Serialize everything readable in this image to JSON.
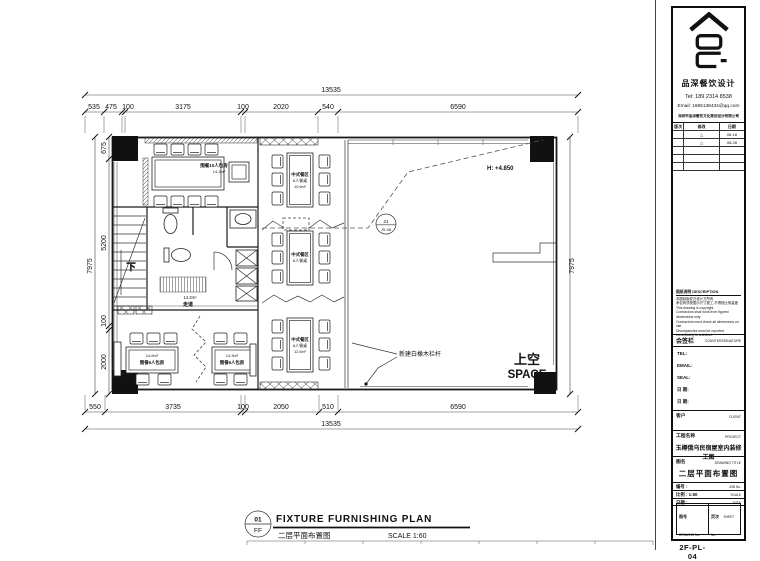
{
  "titleblock": {
    "firm": {
      "name": "品深餐饮设计",
      "tel": "Tel: 189 2314 8538",
      "email": "Email: 1665138434@qq.com",
      "company": "深圳市品深餐饮文化策划设计有限公司"
    },
    "revisions": {
      "col_mark": "版次",
      "col_note": "修改",
      "col_date": "日期",
      "rows": [
        {
          "mark": "△",
          "date": "08.18"
        },
        {
          "mark": "△",
          "date": "08.28"
        }
      ]
    },
    "notes": {
      "title": "图纸说明 DESCRIPTION",
      "lines": [
        "本图纸版权归设计方所有",
        "承包商须按图示尺寸施工,不得按比例量度",
        "This drawing is copyright.",
        "Contractors shall work from figured dimensions only.",
        "Contractors must check all dimensions on site.",
        "Discrepancies must be reported immediately to architect."
      ]
    },
    "countersign": {
      "cn": "会签栏",
      "en": "COUNTERSIGNATURE"
    },
    "sign_rows": [
      "TEL:",
      "EMAIL:",
      "SEAL:",
      "日 期:",
      "日 期:"
    ],
    "client": {
      "cn": "客户",
      "en": "CLIENT"
    },
    "project": {
      "cn": "工程名称",
      "en": "PROJECT",
      "value": "玉樽俄乌民宿屋室内装修工图"
    },
    "drawing_title": {
      "cn": "图名",
      "en": "DRAWING TITLE",
      "value": "二层平面布置图"
    },
    "meta_rows": [
      {
        "label": "编号 :",
        "en": "JOB No."
      },
      {
        "label": "比例 : 1:60",
        "en": "SCALE"
      },
      {
        "label": "日期 :",
        "en": "DATE"
      }
    ],
    "drawing_no": {
      "cn": "图号",
      "en": "DRAWING No.",
      "value": "2F-PL-04"
    },
    "sheet_no": {
      "cn": "页次",
      "en": "SHEET No.",
      "value": ""
    }
  },
  "plan": {
    "dims": {
      "top_total": "13535",
      "top": [
        "535",
        "475",
        "100",
        "3175",
        "100",
        "2020",
        "540",
        "6590"
      ],
      "bottom": [
        "550",
        "3735",
        "100",
        "2050",
        "510",
        "6590"
      ],
      "bottom_total": "13535",
      "left": [
        "675",
        "5200",
        "100",
        "2000"
      ],
      "left_total": "7975",
      "right_total": "7975"
    },
    "labels": {
      "private_room_name": "围餐10人包房",
      "private_room_area": "14.3m²",
      "dining_name": "中式餐区",
      "dining_seats": "6人餐桌",
      "dining1_area": "10.6m²",
      "dining3_area": "12.5m²",
      "room_a_area": "14.6m²",
      "room_a_name": "围餐6人包房",
      "room_b_area": "14.3m²",
      "room_b_name": "围餐6人包房",
      "wc_area": "14.3m²",
      "corridor": "走道",
      "stair_down": "下",
      "height_note": "H: +4.850",
      "marker_top": "21",
      "marker_bottom": "JS-08",
      "railing_note": "新建白橡木栏杆",
      "void_cn": "上空",
      "void_en": "SPACE"
    },
    "caption": {
      "num": "01",
      "floor": "FF",
      "title_en": "FIXTURE FURNISHING PLAN",
      "title_cn": "二层平面布置图",
      "scale": "SCALE 1:60"
    }
  }
}
